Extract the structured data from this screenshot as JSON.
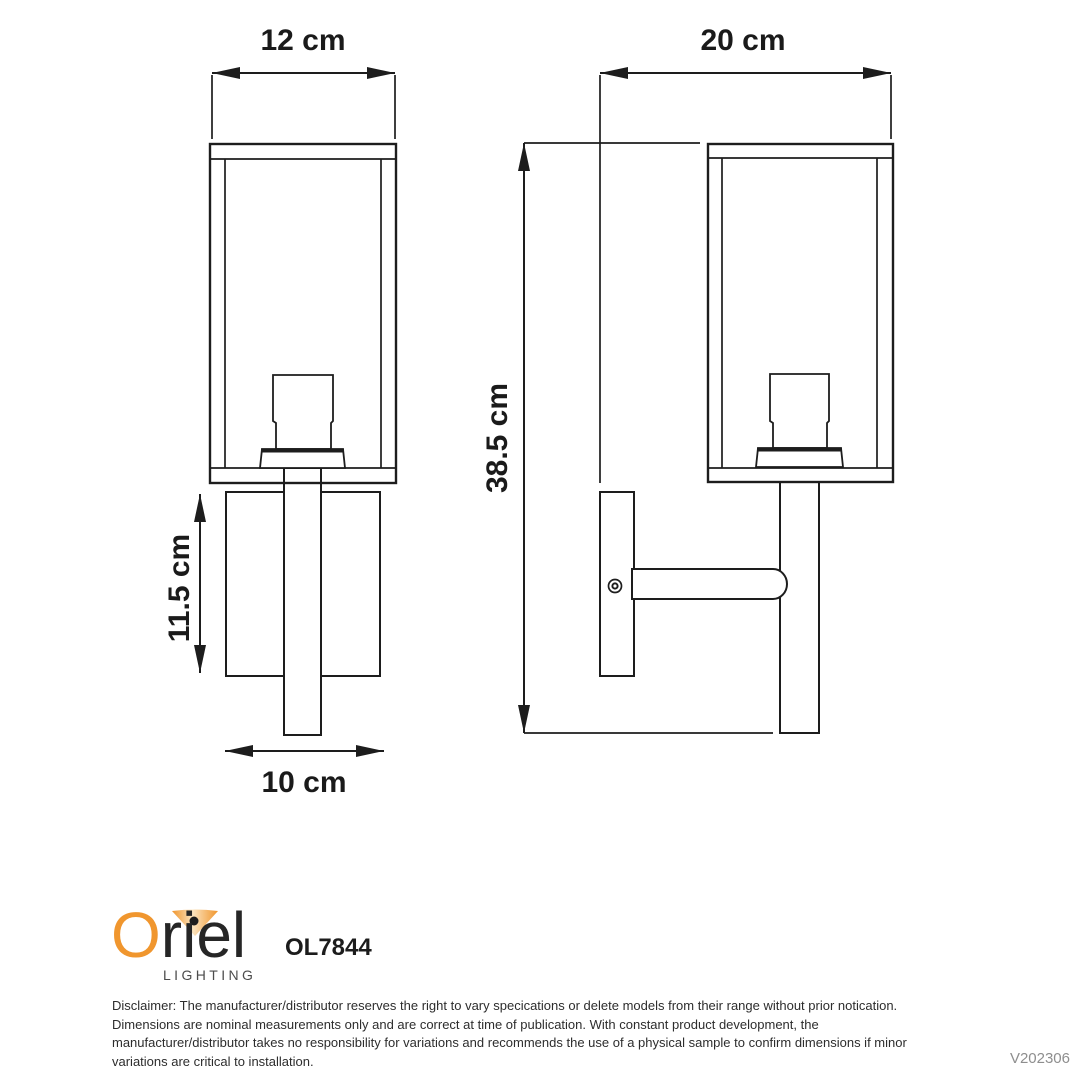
{
  "product": {
    "brand_initial": "O",
    "brand_rest": "riel",
    "brand_sub": "LIGHTING",
    "model": "OL7844"
  },
  "dimensions": {
    "front_width": "12 cm",
    "side_depth": "20 cm",
    "overall_height": "38.5 cm",
    "backplate_height": "11.5 cm",
    "backplate_width": "10 cm"
  },
  "footer": {
    "disclaimer_lines": [
      "Disclaimer: The manufacturer/distributor reserves the right to vary specications or delete models from their range without prior notication.",
      "Dimensions are nominal measurements only and are correct at time of publication. With constant product development, the",
      "manufacturer/distributor takes no responsibility for variations and recommends the use of a physical sample to confirm dimensions if minor",
      "variations are critical to installation."
    ],
    "version": "V202306"
  },
  "colors": {
    "line": "#1d1d1d",
    "logo_orange": "#F0962E",
    "shade_pale": "#FBE4BF",
    "version_gray": "#8e8e8e"
  }
}
